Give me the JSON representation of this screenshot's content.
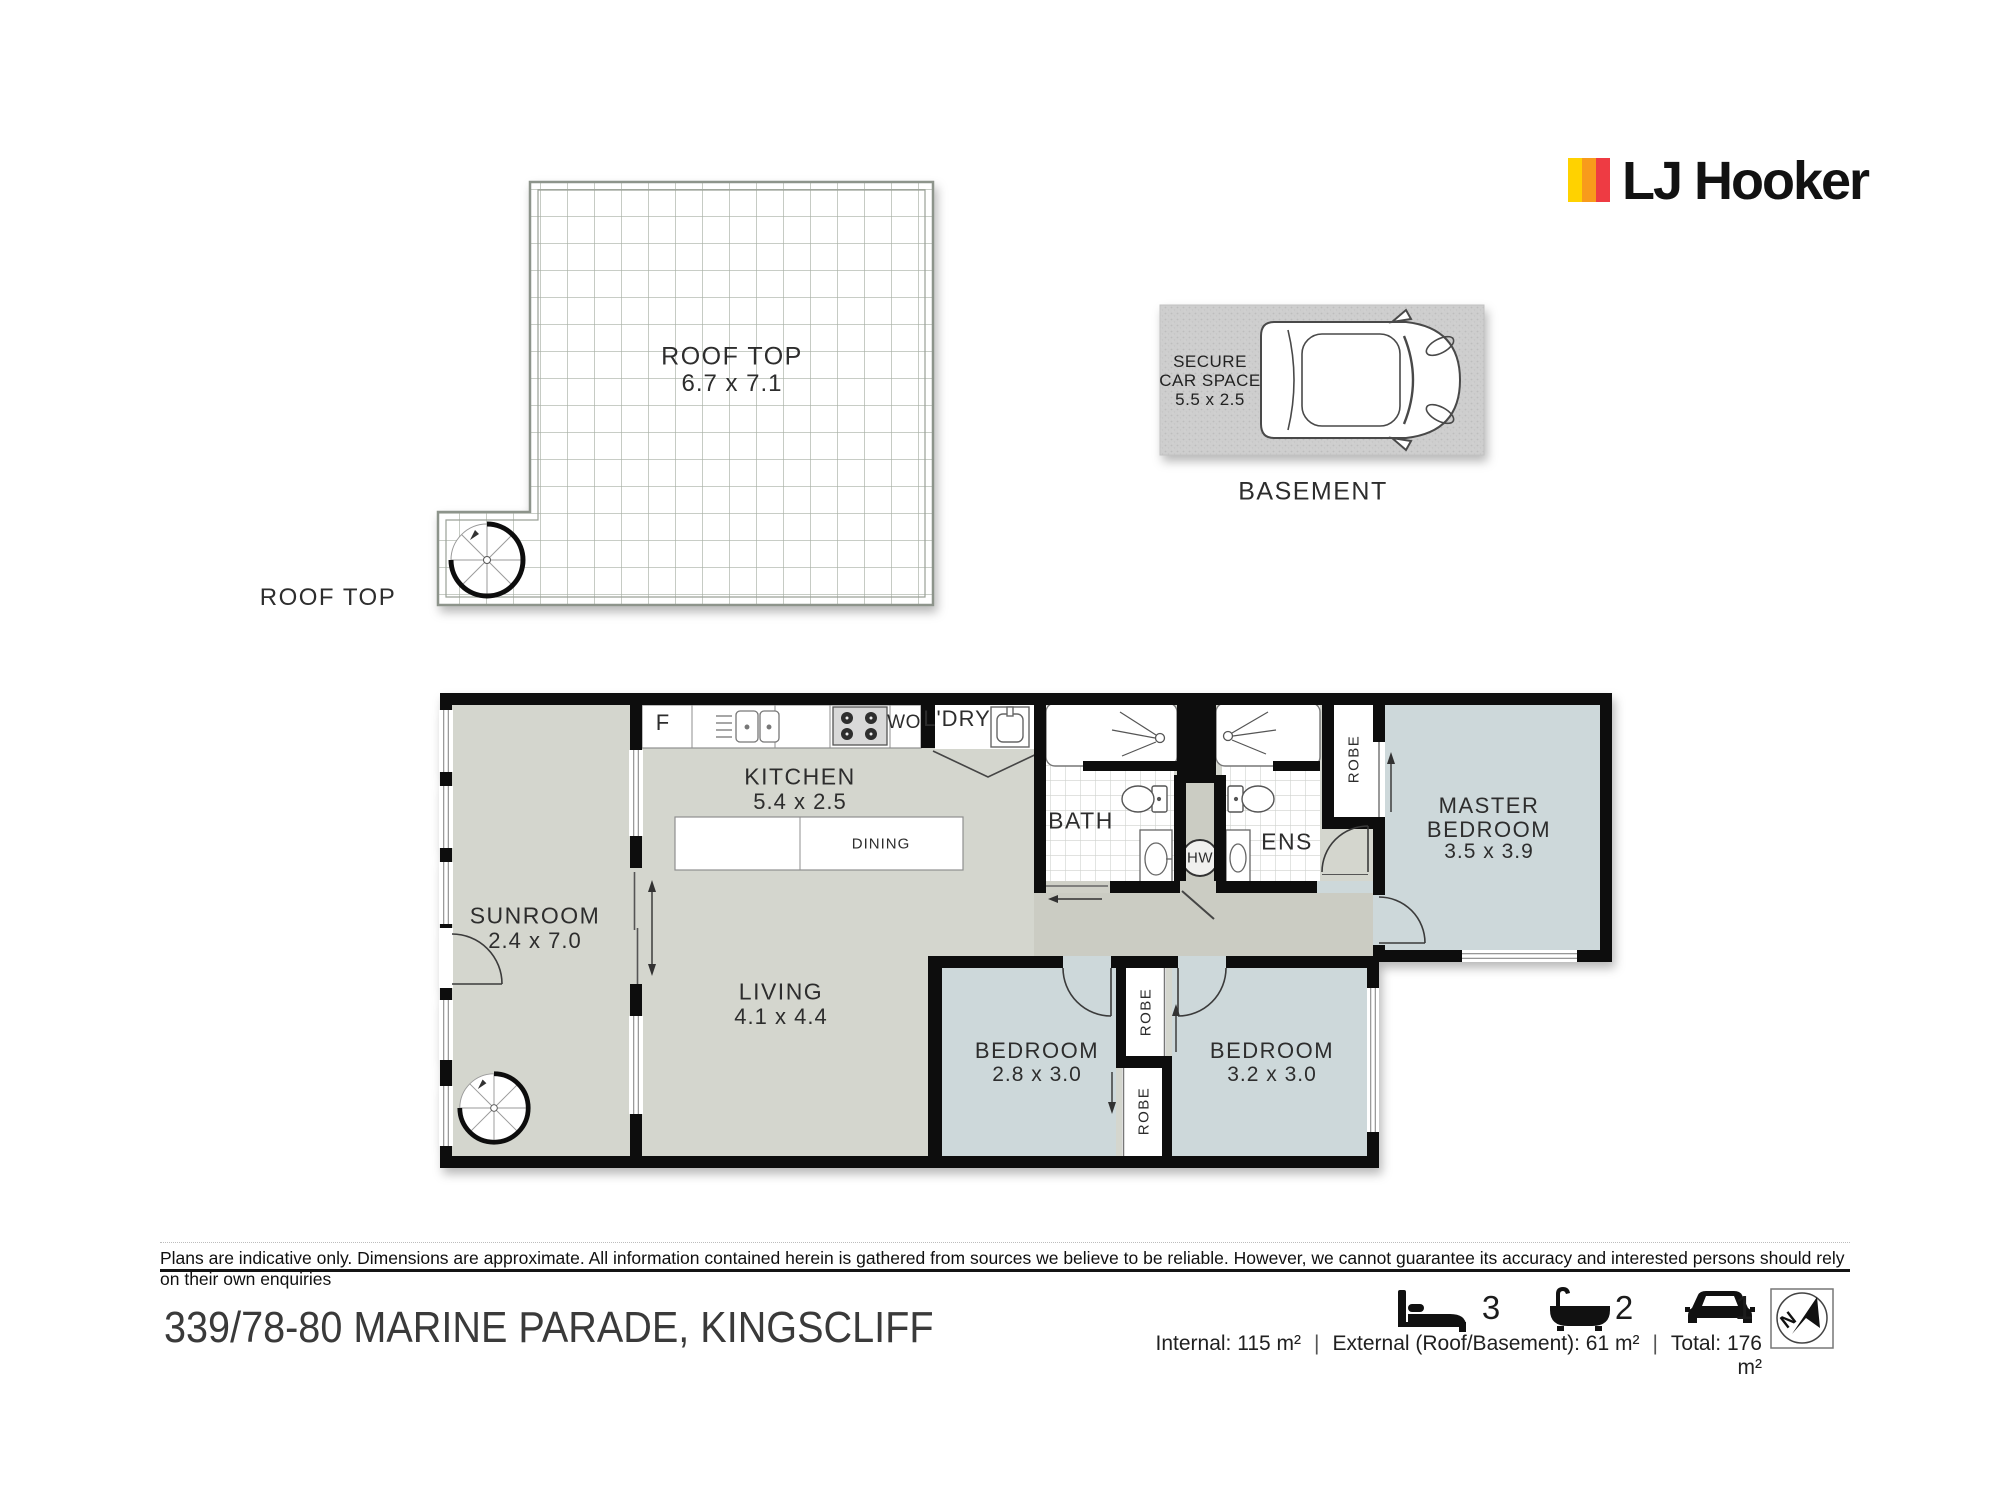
{
  "logo": {
    "brand": "LJ Hooker",
    "stripe_colors": [
      "#FFD200",
      "#F89B1B",
      "#EE3B43"
    ]
  },
  "roof_plan": {
    "label": "ROOF TOP",
    "dims": "6.7 x 7.1",
    "side_label": "ROOF TOP"
  },
  "basement": {
    "label": "BASEMENT",
    "space_line1": "SECURE",
    "space_line2": "CAR SPACE",
    "space_dims": "5.5 x 2.5"
  },
  "floor_plan": {
    "sunroom_name": "SUNROOM",
    "sunroom_dims": "2.4 x 7.0",
    "kitchen_name": "KITCHEN",
    "kitchen_dims": "5.4 x 2.5",
    "dining_name": "DINING",
    "living_name": "LIVING",
    "living_dims": "4.1 x 4.4",
    "bath_name": "BATH",
    "ens_name": "ENS",
    "laundry_name": "L'DRY",
    "master_line1": "MASTER",
    "master_line2": "BEDROOM",
    "master_dims": "3.5 x 3.9",
    "bedroom2_name": "BEDROOM",
    "bedroom2_dims": "2.8 x 3.0",
    "bedroom3_name": "BEDROOM",
    "bedroom3_dims": "3.2 x 3.0",
    "fridge": "F",
    "wall_oven": "WO",
    "hot_water": "HW",
    "robe": "ROBE",
    "floor_colors": {
      "living": "#d4d6ce",
      "bedroom": "#cdd8da",
      "hall": "#cbccc3",
      "wall": "#101010"
    }
  },
  "footer": {
    "disclaimer": "Plans are indicative only. Dimensions are approximate. All information contained herein is gathered from sources we believe to be reliable. However, we cannot guarantee its accuracy and interested persons should rely on their own enquiries",
    "address": "339/78-80 MARINE PARADE, KINGSCLIFF",
    "beds": "3",
    "baths": "2",
    "cars": "1",
    "compass_letter": "N",
    "areas": {
      "internal": "Internal: 115 m²",
      "external": "External (Roof/Basement): 61 m²",
      "total": "Total: 176 m²",
      "separator": "|"
    },
    "icons": {
      "beds": "bed-icon",
      "baths": "bath-icon",
      "cars": "car-icon",
      "compass": "north-compass-icon"
    }
  }
}
